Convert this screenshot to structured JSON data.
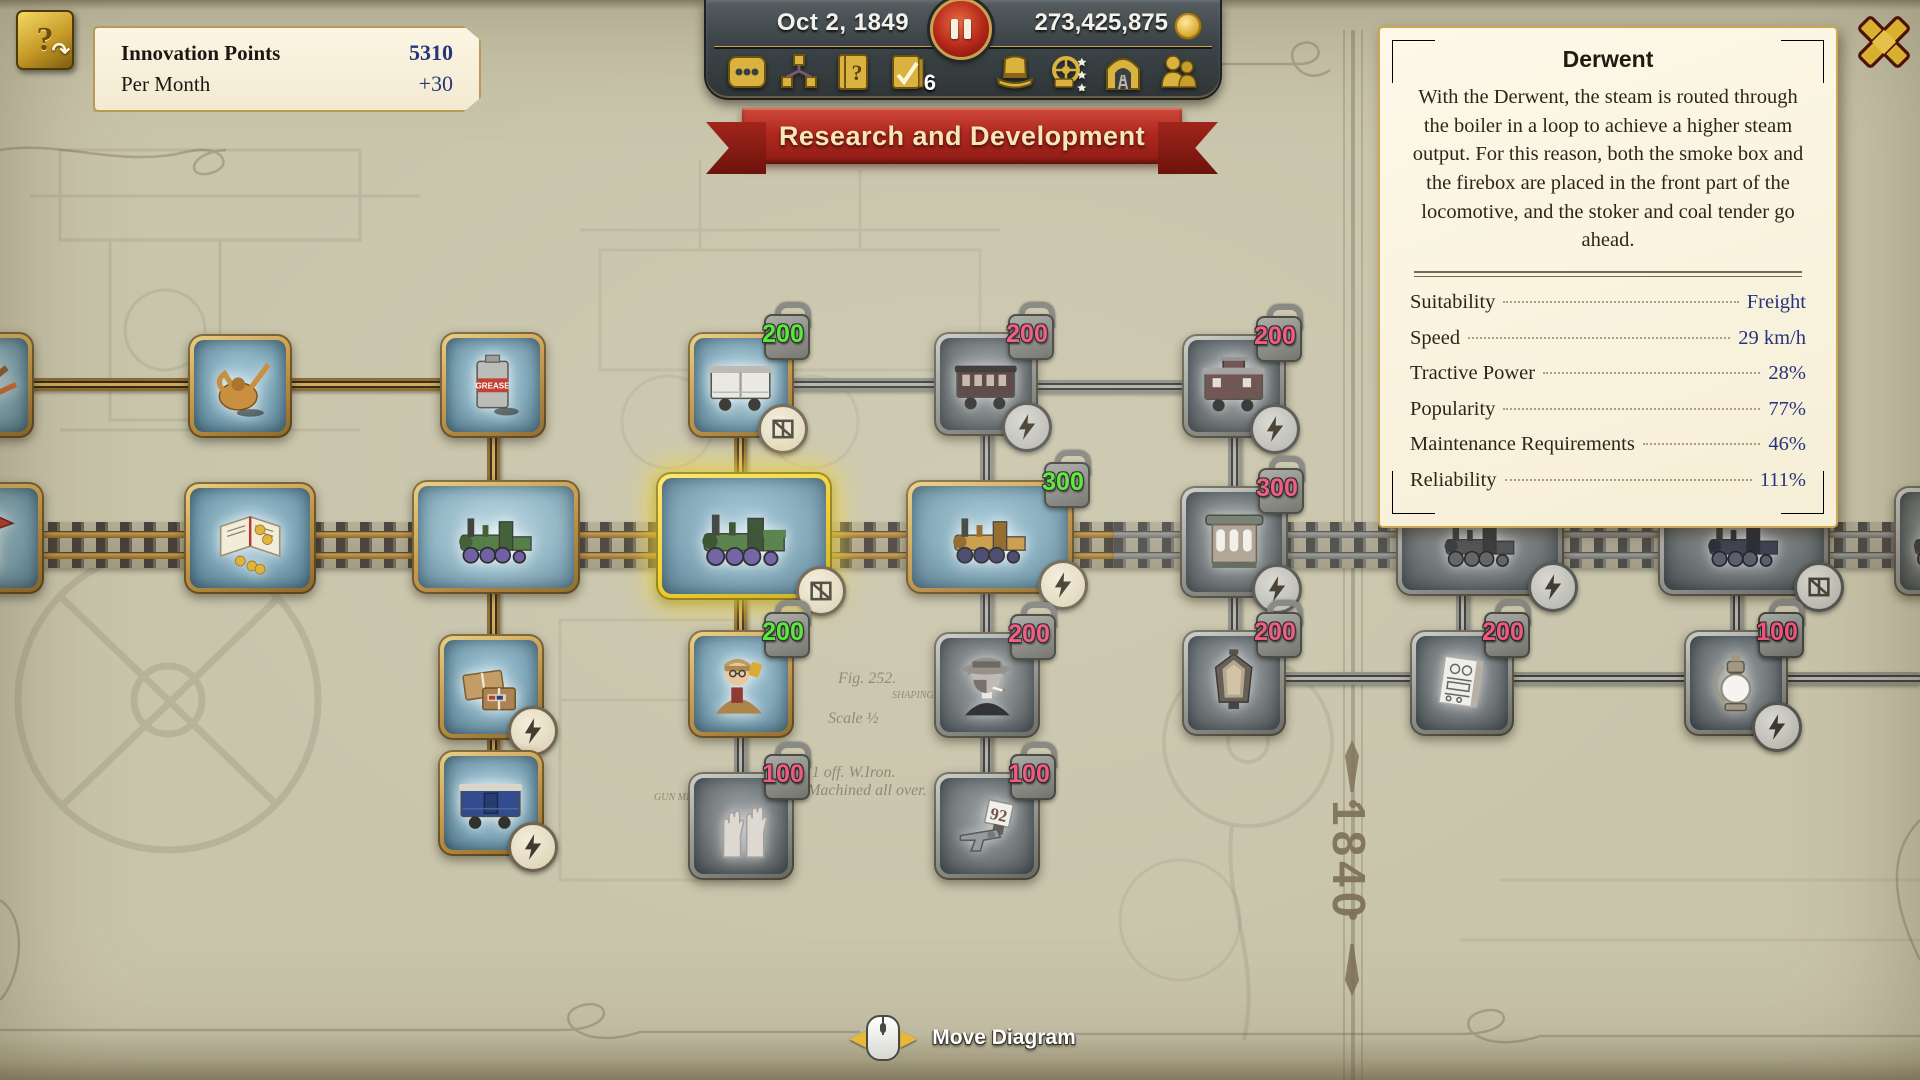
{
  "hud": {
    "innovation": {
      "title": "Innovation Points",
      "value": "5310",
      "per_month_label": "Per Month",
      "per_month_value": "+30",
      "icon": "innovation-book-icon"
    },
    "date": "Oct 2, 1849",
    "money": "273,425,875",
    "toolbar": {
      "tasks_count": "6",
      "items": [
        {
          "name": "menu-dots-icon"
        },
        {
          "name": "research-tree-icon"
        },
        {
          "name": "help-book-icon"
        },
        {
          "name": "task-list-icon"
        },
        {
          "name": "top-hat-icon"
        },
        {
          "name": "wheel-stars-icon"
        },
        {
          "name": "tunnel-icon"
        },
        {
          "name": "personnel-icon"
        }
      ]
    },
    "banner": "Research and Development",
    "move_hint": "Move Diagram",
    "era_marker": "1840"
  },
  "panel": {
    "title": "Derwent",
    "description": "With the Derwent, the steam is routed through the boiler in a loop to achieve a higher steam output. For this reason, both the smoke box and the firebox are placed in the front part of the locomotive, and the stoker and coal tender go ahead.",
    "stats": [
      {
        "label": "Suitability",
        "value": "Freight"
      },
      {
        "label": "Speed",
        "value": "29 km/h"
      },
      {
        "label": "Tractive Power",
        "value": "28%"
      },
      {
        "label": "Popularity",
        "value": "77%"
      },
      {
        "label": "Maintenance Requirements",
        "value": "46%"
      },
      {
        "label": "Reliability",
        "value": "111%"
      }
    ]
  },
  "colors": {
    "badge_green": "#4fe82e",
    "badge_red": "#f0537a",
    "gold": "#c9a14f",
    "banner_red": "#b0281f",
    "panel_cream": "#f8f1dd",
    "value_blue": "#27357d"
  },
  "tree": {
    "track": {
      "y": 522,
      "active_width": 1114,
      "total_width": 1920
    },
    "nodes": [
      {
        "id": "rails-partial",
        "x": -72,
        "y": 332,
        "w": 106,
        "h": 106,
        "state": "unlocked",
        "item": "rails"
      },
      {
        "id": "oil-can",
        "x": 188,
        "y": 334,
        "w": 104,
        "h": 104,
        "state": "unlocked",
        "item": "oilcan"
      },
      {
        "id": "grease-can",
        "x": 440,
        "y": 332,
        "w": 106,
        "h": 106,
        "state": "unlocked",
        "item": "grease",
        "item_label": "GREASE"
      },
      {
        "id": "white-boxcar",
        "x": 688,
        "y": 332,
        "w": 106,
        "h": 106,
        "state": "research",
        "item": "wagon_white",
        "badge": "200",
        "badge_color": "green",
        "icon": "freight"
      },
      {
        "id": "passenger-car",
        "x": 934,
        "y": 332,
        "w": 104,
        "h": 104,
        "state": "locked",
        "item": "wagon_maroon",
        "badge": "200",
        "badge_color": "red",
        "icon": "express"
      },
      {
        "id": "caboose",
        "x": 1182,
        "y": 334,
        "w": 104,
        "h": 104,
        "state": "locked",
        "item": "caboose",
        "badge": "200",
        "badge_color": "red",
        "icon": "express"
      },
      {
        "id": "kiosk-partial",
        "x": -88,
        "y": 482,
        "w": 132,
        "h": 112,
        "state": "unlocked",
        "item": "kiosk"
      },
      {
        "id": "account-book",
        "x": 184,
        "y": 482,
        "w": 132,
        "h": 112,
        "state": "unlocked",
        "item": "book"
      },
      {
        "id": "loco-researched",
        "x": 412,
        "y": 480,
        "w": 168,
        "h": 114,
        "state": "researched",
        "item": "loco_green"
      },
      {
        "id": "loco-derwent",
        "x": 656,
        "y": 472,
        "w": 176,
        "h": 128,
        "state": "selected",
        "item": "loco_derwent",
        "icon": "freight"
      },
      {
        "id": "loco-gold",
        "x": 906,
        "y": 480,
        "w": 168,
        "h": 114,
        "state": "research",
        "item": "loco_gold",
        "badge": "300",
        "badge_color": "green",
        "icon": "express"
      },
      {
        "id": "horse-tram",
        "x": 1180,
        "y": 486,
        "w": 108,
        "h": 112,
        "state": "locked",
        "item": "trolley",
        "badge": "300",
        "badge_color": "red",
        "icon": "express"
      },
      {
        "id": "loco-locked-a",
        "x": 1396,
        "y": 486,
        "w": 168,
        "h": 110,
        "state": "locked",
        "item": "loco_dark",
        "icon": "express"
      },
      {
        "id": "loco-locked-b",
        "x": 1658,
        "y": 486,
        "w": 172,
        "h": 110,
        "state": "locked",
        "item": "loco_blue",
        "icon": "freight"
      },
      {
        "id": "loco-edge-partial",
        "x": 1894,
        "y": 486,
        "w": 110,
        "h": 110,
        "state": "locked",
        "item": "loco_dark",
        "icon": "freight"
      },
      {
        "id": "parcels",
        "x": 438,
        "y": 634,
        "w": 106,
        "h": 106,
        "state": "unlocked",
        "item": "packages",
        "icon": "express"
      },
      {
        "id": "conductor",
        "x": 688,
        "y": 630,
        "w": 106,
        "h": 108,
        "state": "research",
        "item": "conductor",
        "badge": "200",
        "badge_color": "green"
      },
      {
        "id": "gangster",
        "x": 934,
        "y": 632,
        "w": 106,
        "h": 106,
        "state": "locked",
        "item": "gangster",
        "badge": "200",
        "badge_color": "red"
      },
      {
        "id": "headlamp",
        "x": 1182,
        "y": 630,
        "w": 104,
        "h": 106,
        "state": "locked",
        "item": "headlamp",
        "badge": "200",
        "badge_color": "red"
      },
      {
        "id": "blueprint-paper",
        "x": 1410,
        "y": 630,
        "w": 104,
        "h": 106,
        "state": "locked",
        "item": "paper",
        "badge": "200",
        "badge_color": "red"
      },
      {
        "id": "oil-lamp",
        "x": 1684,
        "y": 630,
        "w": 104,
        "h": 106,
        "state": "locked",
        "item": "lamp",
        "badge": "100",
        "badge_color": "red",
        "icon": "express"
      },
      {
        "id": "blue-boxcar",
        "x": 438,
        "y": 750,
        "w": 106,
        "h": 106,
        "state": "unlocked",
        "item": "wagon_blue",
        "icon": "express"
      },
      {
        "id": "raised-hands",
        "x": 688,
        "y": 772,
        "w": 106,
        "h": 108,
        "state": "locked",
        "item": "hands",
        "badge": "100",
        "badge_color": "red"
      },
      {
        "id": "revolver-92",
        "x": 934,
        "y": 772,
        "w": 106,
        "h": 108,
        "state": "locked",
        "item": "revolver",
        "badge": "100",
        "badge_color": "red",
        "item_label": "92"
      }
    ],
    "connectors": [
      {
        "kind": "brass-h",
        "x": 0,
        "y": 378,
        "len": 446
      },
      {
        "kind": "gray-h",
        "x": 792,
        "y": 378,
        "len": 146
      },
      {
        "kind": "gray-h",
        "x": 1036,
        "y": 380,
        "len": 150
      },
      {
        "kind": "brass-v",
        "x": 487,
        "y": 436,
        "len": 50
      },
      {
        "kind": "brass-v",
        "x": 734,
        "y": 436,
        "len": 42
      },
      {
        "kind": "gray-v",
        "x": 980,
        "y": 434,
        "len": 52
      },
      {
        "kind": "gray-v",
        "x": 1228,
        "y": 436,
        "len": 56
      },
      {
        "kind": "brass-v",
        "x": 487,
        "y": 592,
        "len": 48
      },
      {
        "kind": "brass-v",
        "x": 487,
        "y": 738,
        "len": 18
      },
      {
        "kind": "brass-v",
        "x": 734,
        "y": 598,
        "len": 38
      },
      {
        "kind": "gray-v",
        "x": 734,
        "y": 736,
        "len": 42
      },
      {
        "kind": "gray-v",
        "x": 980,
        "y": 592,
        "len": 46
      },
      {
        "kind": "gray-v",
        "x": 980,
        "y": 736,
        "len": 42
      },
      {
        "kind": "gray-v",
        "x": 1228,
        "y": 596,
        "len": 40
      },
      {
        "kind": "gray-v",
        "x": 1456,
        "y": 594,
        "len": 42
      },
      {
        "kind": "gray-v",
        "x": 1730,
        "y": 594,
        "len": 42
      },
      {
        "kind": "gray-h",
        "x": 1284,
        "y": 672,
        "len": 130
      },
      {
        "kind": "gray-h",
        "x": 1512,
        "y": 672,
        "len": 176
      },
      {
        "kind": "gray-h",
        "x": 1786,
        "y": 672,
        "len": 134
      }
    ]
  },
  "background_texts": [
    {
      "t": "Fig. 252.",
      "x": 838,
      "y": 670,
      "s": 16
    },
    {
      "t": "SHAPING",
      "x": 892,
      "y": 690,
      "s": 10
    },
    {
      "t": "Scale ½",
      "x": 828,
      "y": 710,
      "s": 16
    },
    {
      "t": "Rod.  1 off.  W.Iron.",
      "x": 778,
      "y": 764,
      "s": 16
    },
    {
      "t": "XI.   Machined all  over.",
      "x": 784,
      "y": 782,
      "s": 16
    },
    {
      "t": "GUN METAL",
      "x": 654,
      "y": 792,
      "s": 10
    }
  ]
}
